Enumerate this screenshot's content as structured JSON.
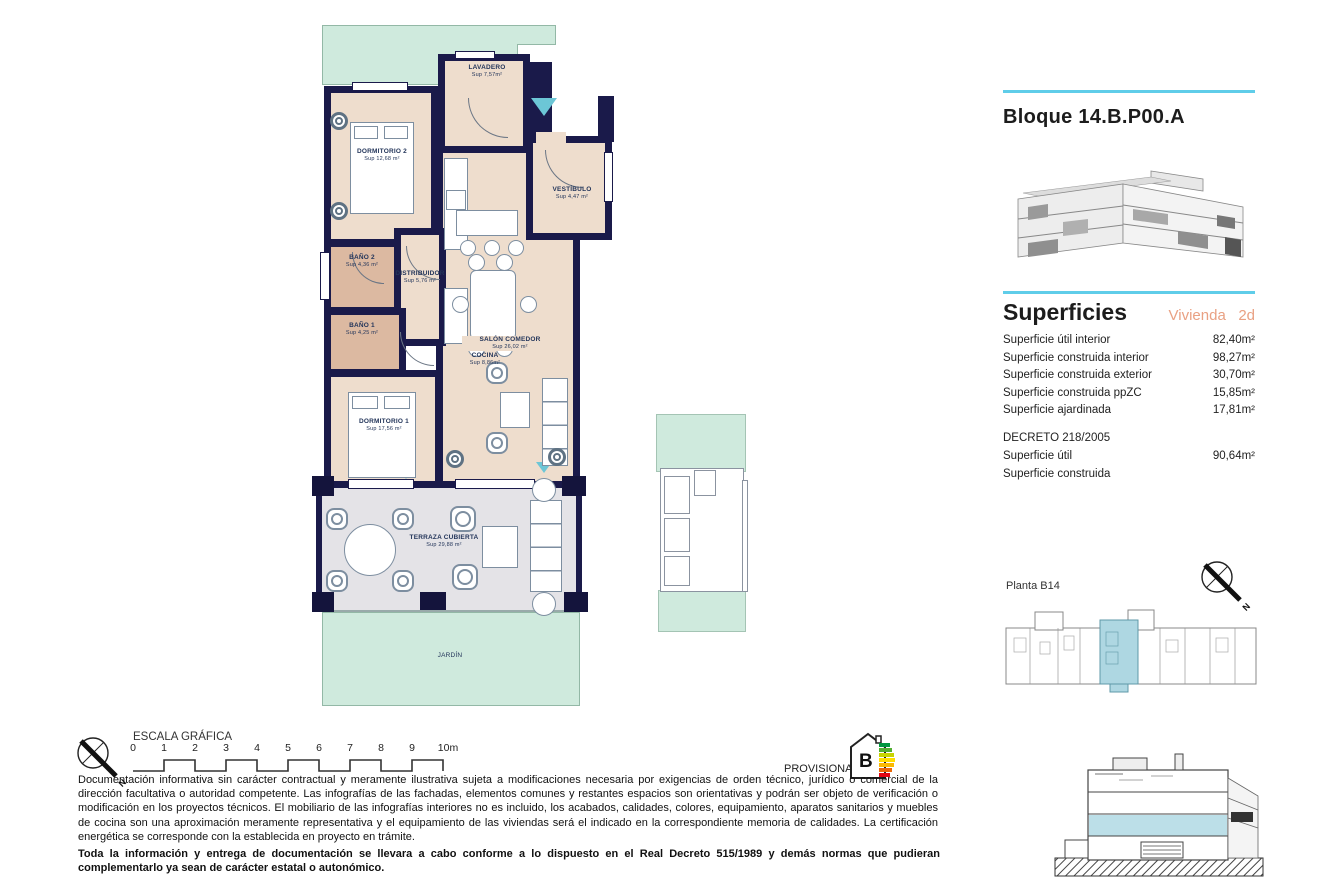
{
  "header": {
    "title": "Bloque 14.B.P00.A"
  },
  "superficies": {
    "heading": "Superficies",
    "vivienda_label": "Vivienda",
    "vivienda_value": "2d",
    "rows": [
      {
        "label": "Superficie útil interior",
        "value": "82,40m²"
      },
      {
        "label": "Superficie construida interior",
        "value": "98,27m²"
      },
      {
        "label": "Superficie construida exterior",
        "value": "30,70m²"
      },
      {
        "label": "Superficie construida ppZC",
        "value": "15,85m²"
      },
      {
        "label": "Superficie ajardinada",
        "value": "17,81m²"
      }
    ],
    "decreto": {
      "heading": "DECRETO 218/2005",
      "rows": [
        {
          "label": "Superficie útil",
          "value": "90,64m²"
        },
        {
          "label": "Superficie construida",
          "value": ""
        }
      ]
    }
  },
  "plan": {
    "rooms": [
      {
        "name": "DORMITORIO 2",
        "area": "Sup 12,68 m²"
      },
      {
        "name": "LAVADERO",
        "area": "Sup 7,57m²"
      },
      {
        "name": "VESTÍBULO",
        "area": "Sup 4,47 m²"
      },
      {
        "name": "COCINA",
        "area": "Sup 8,86m²"
      },
      {
        "name": "BAÑO 2",
        "area": "Sup 4,36 m²"
      },
      {
        "name": "DISTRIBUIDOR",
        "area": "Sup 5,76 m²"
      },
      {
        "name": "BAÑO 1",
        "area": "Sup 4,25 m²"
      },
      {
        "name": "SALÓN COMEDOR",
        "area": "Sup 26,02 m²"
      },
      {
        "name": "DORMITORIO 1",
        "area": "Sup 17,56 m²"
      },
      {
        "name": "TERRAZA CUBIERTA",
        "area": "Sup 29,88 m²"
      },
      {
        "name": "JARDÍN",
        "area": ""
      }
    ]
  },
  "keyplan": {
    "label": "Planta B14"
  },
  "compass": {
    "north_label": "N"
  },
  "scale": {
    "heading": "ESCALA GRÁFICA",
    "ticks": [
      "0",
      "1",
      "2",
      "3",
      "4",
      "5",
      "6",
      "7",
      "8",
      "9",
      "10m"
    ]
  },
  "energy": {
    "provisional_label": "PROVISIONAL",
    "rating": "B",
    "bar_colors": [
      "#009640",
      "#52ae32",
      "#c8d400",
      "#ffde00",
      "#fbba00",
      "#eb6909",
      "#e30613"
    ]
  },
  "footer": {
    "paragraph1": "Documentación informativa sin carácter contractual y meramente ilustrativa sujeta a modificaciones necesaria por exigencias de orden técnico, jurídico o comercial de la dirección facultativa o autoridad competente. Las infografías de las fachadas, elementos comunes y restantes espacios son orientativas y podrán ser objeto de verificación o modificación en los proyectos técnicos. El mobiliario de las infografías interiores no es incluido, los acabados, calidades, colores, equipamiento, aparatos sanitarios y muebles de cocina son una aproximación meramente representativa y el equipamiento de las viviendas será el indicado en la correspondiente memoria de calidades. La certificación energética se corresponde con la establecida en proyecto en trámite.",
    "paragraph2": "Toda la información y entrega de documentación se llevara a cabo conforme a lo dispuesto en el Real Decreto 515/1989 y demás normas que pudieran complementarlo ya sean de carácter estatal o autonómico."
  },
  "colors": {
    "accent_cyan": "#5fcde9",
    "wall_navy": "#1a1a4a",
    "floor_beige": "#eeddcd",
    "bath_tan": "#dcb9a1",
    "terrace_gray": "#e4e3e7",
    "garden_mint": "#cfeadd",
    "keyplan_highlight": "#aed7e2",
    "vivienda_orange": "#e9a183",
    "entry_arrow": "#6cc6d6"
  }
}
